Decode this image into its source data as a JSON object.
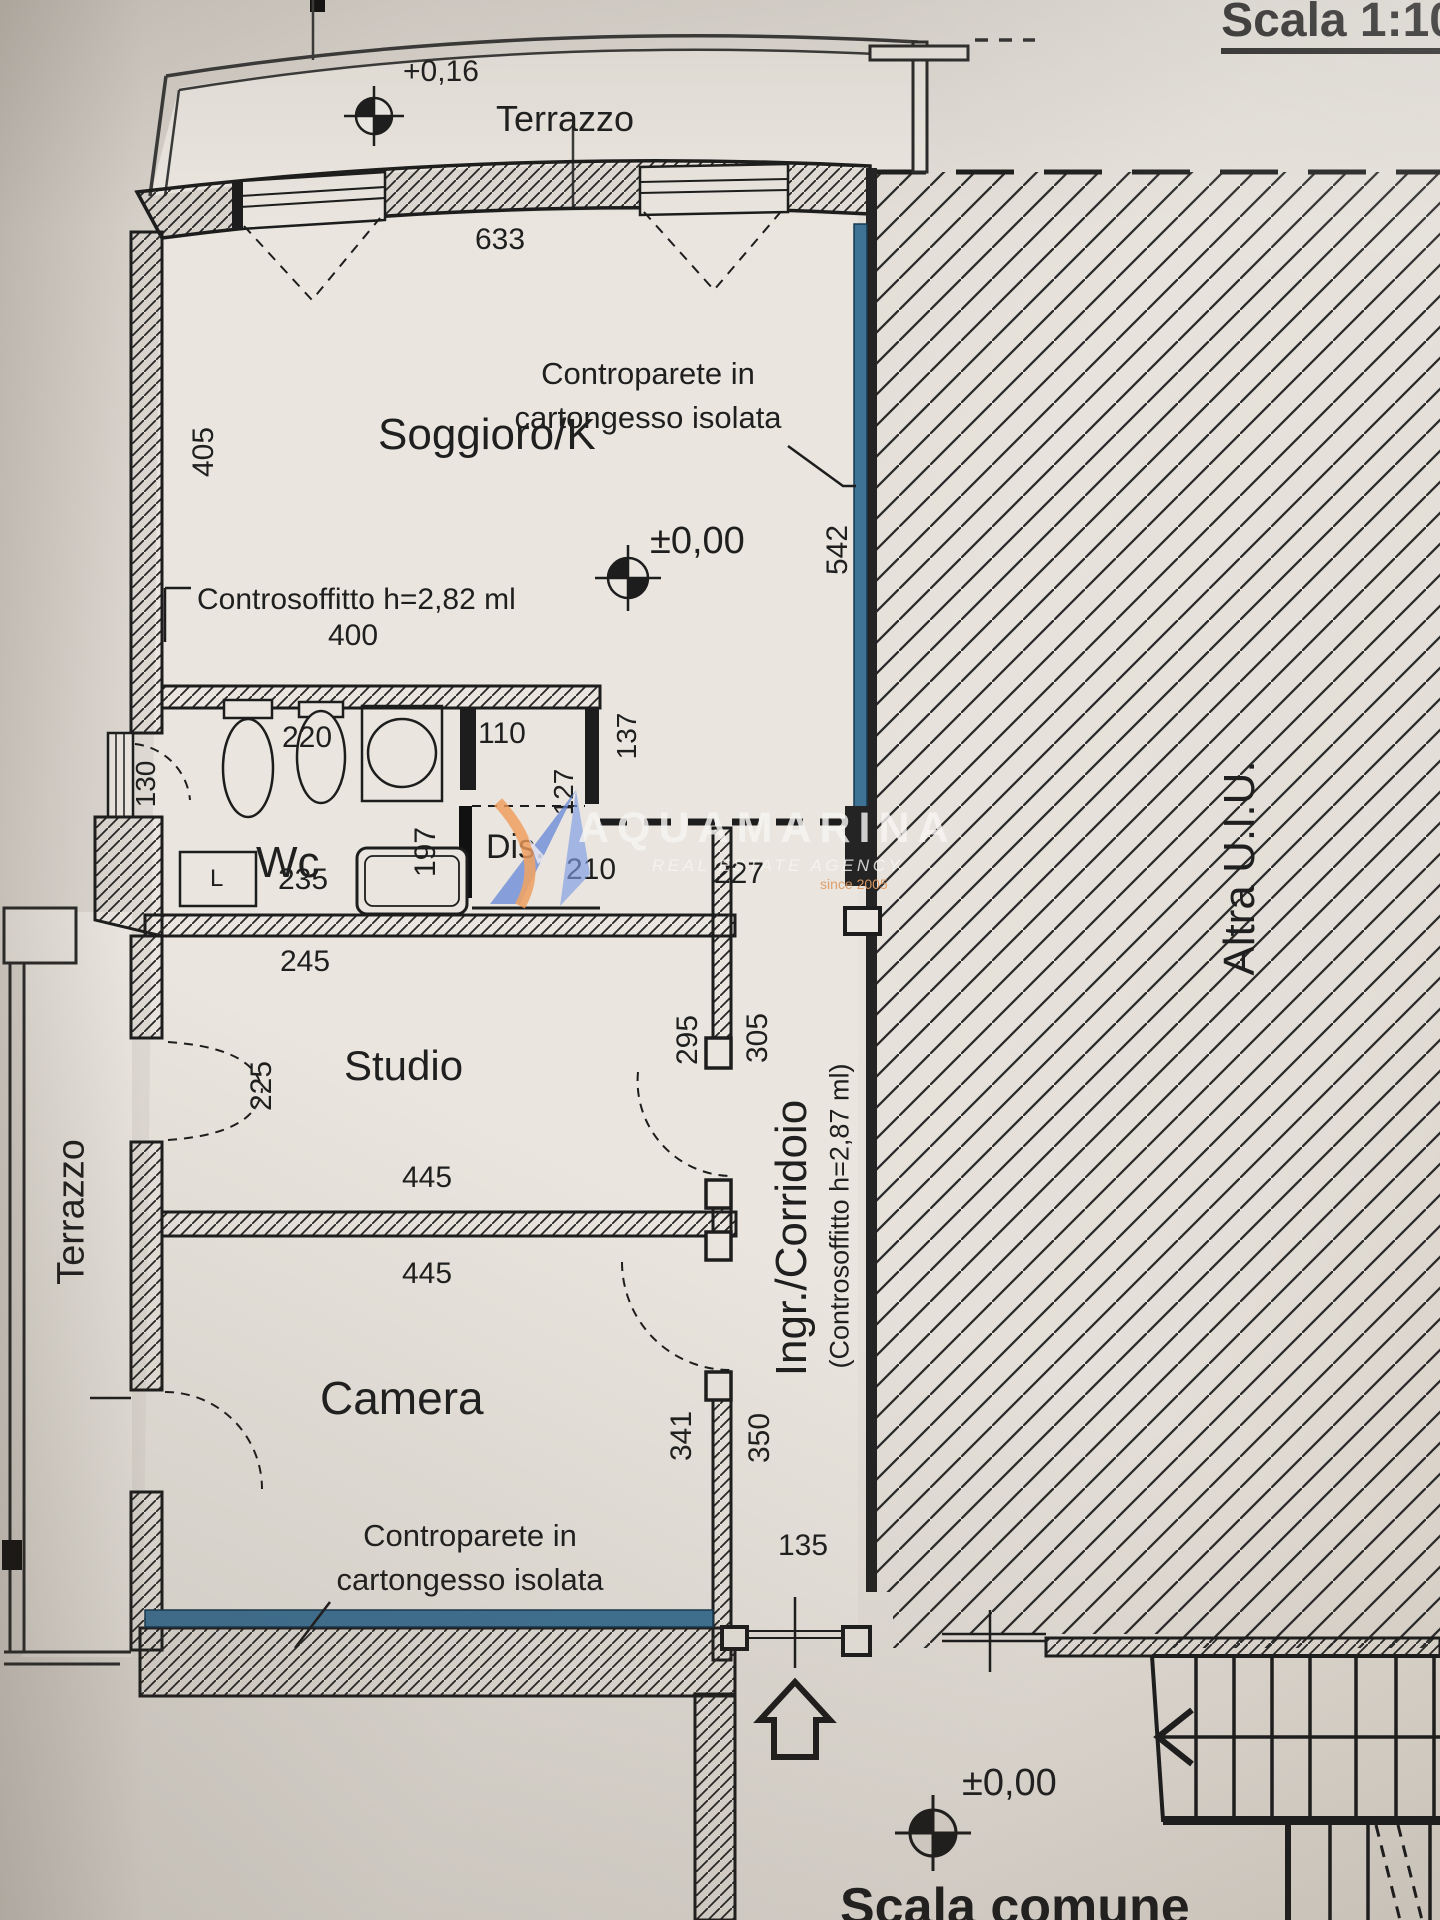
{
  "header": {
    "scale_title": "Scala 1:10"
  },
  "levels": {
    "terrace": "+0,16",
    "main_floor": "±0,00",
    "stair_landing": "±0,00"
  },
  "rooms": {
    "living": "Soggioro/K",
    "wc": "Wc",
    "storage": "Dis.",
    "studio": "Studio",
    "bedroom": "Camera",
    "hall": "Ingr./Corridoio",
    "terrace_top": "Terrazzo",
    "terrace_left": "Terrazzo"
  },
  "annotations": {
    "counterwall_top_line1": "Controparete in",
    "counterwall_top_line2": "cartongesso isolata",
    "false_ceiling_living": "Controsoffitto h=2,82 ml",
    "corridor_note": "(Controsoffitto h=2,87 ml)",
    "counterwall_bottom_line1": "Controparete in",
    "counterwall_bottom_line2": "cartongesso isolata",
    "other_unit": "Altra U.I.U.",
    "common_stair": "Scala comune"
  },
  "dimensions": {
    "d633": "633",
    "d405": "405",
    "d542": "542",
    "d400": "400",
    "d220": "220",
    "d110": "110",
    "d127": "127",
    "d137": "137",
    "d197": "197",
    "d227": "227",
    "d130": "130",
    "d235": "235",
    "d210": "210",
    "d245": "245",
    "d295": "295",
    "d305": "305",
    "d225": "225",
    "d445_studio": "445",
    "d445_camera": "445",
    "d341": "341",
    "d350": "350",
    "d135": "135"
  },
  "fixtures": {
    "washing_machine": "L"
  },
  "watermark": {
    "brand": "AQUAMARINA",
    "tagline": "REAL ESTATE AGENCY",
    "since": "since 2005"
  },
  "colors": {
    "accent_blue": "#3f7396",
    "paper": "#d9d3cb",
    "ink": "#1d1d1d",
    "watermark_blue": "#6487d8",
    "watermark_orange": "#ef9a58"
  }
}
